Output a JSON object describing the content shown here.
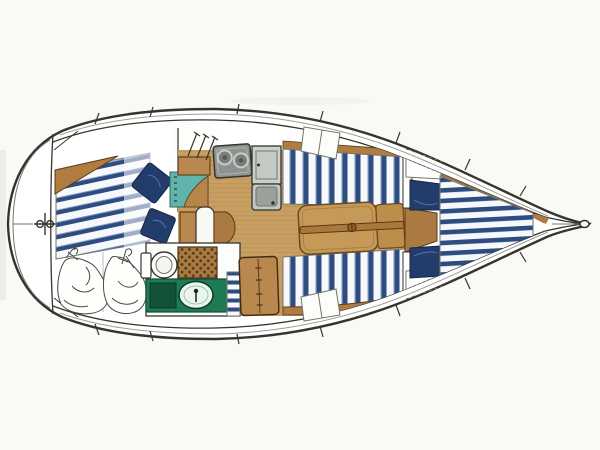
{
  "diagram": {
    "title": "Sailboat interior layout floor plan, top view, bow pointing right",
    "type": "boat-floor-plan",
    "orientation": {
      "bow": "right",
      "stern": "left"
    },
    "rooms": [
      {
        "id": "stern-deck",
        "label": "Stern deck with windlass fitting and centerline mark"
      },
      {
        "id": "aft-cabin",
        "label": "Aft cabin with striped double berth, two navy pillows and wood corner wedge"
      },
      {
        "id": "sail-locker",
        "label": "Stowage locker with two crumpled sail bags"
      },
      {
        "id": "head",
        "label": "Head compartment with marine toilet, wicker shower grate and green vanity basin"
      },
      {
        "id": "galley",
        "label": "Galley with two-burner stove, locker door and single sink"
      },
      {
        "id": "salon",
        "label": "Salon with wood sole, two striped settees and folding table"
      },
      {
        "id": "forward-cabin",
        "label": "Forward cabin with V-berth, two navy cushions and wood hull trim"
      },
      {
        "id": "bow",
        "label": "Bow tip with anchor roller fitting"
      }
    ],
    "furniture": {
      "aft_berth": "striped athwartships double berth",
      "pillows": "two navy pillows",
      "teal_counter": "teal counter with wood shelf and curved wood top",
      "toilet": "marine toilet with tank and pump",
      "shower_grate": "wicker shower grate",
      "vanity": "green vanity with oval basin and faucet",
      "towel": "striped towel panel",
      "steps_cabinet": "wood companionway step cabinet with double doors",
      "nav_seat": "white seat with wood cabinet and rounded side table",
      "stove": "two-burner gimbaled stove",
      "galley_locker": "galley locker door with handle",
      "galley_sink": "single-basin stainless sink",
      "settees": "port and starboard striped salon settees with wood trim",
      "table": "folding salon table with center rail and leaf",
      "v_berth": "striped V-berth mattress",
      "fwd_cushions": "two navy forward-cabin cushions"
    }
  },
  "colors": {
    "paper": "#faf9f5",
    "hullWhite": "#ffffff",
    "deckWhite": "#fdfdfb",
    "line": "#35352e",
    "lineSoft": "#75756b",
    "sketch": "#4a4a44",
    "woodFloor": "#c89f63",
    "woodPlank": "#a87c3e",
    "woodTrim": "#b07c40",
    "woodBox": "#b8884e",
    "woodTable": "#c59a58",
    "woodRail": "#a9783a",
    "woodEdge": "#5a3a18",
    "navy": "#2d4c80",
    "navyDark": "#223d6b",
    "navyEdge": "#16284a",
    "navyLight": "#7e97c1",
    "stripeWhite": "#f6f8fb",
    "teal": "#5fb4ab",
    "tealDark": "#2e6b63",
    "applianceGray": "#8f938f",
    "applianceLight": "#ccd0cc",
    "basinGray": "#9aa09c",
    "green": "#1e7a52",
    "greenDark": "#135239",
    "basinGreen": "#eaf5ee",
    "wicker": "#a87b44",
    "wickerDot": "#5f3d16"
  }
}
